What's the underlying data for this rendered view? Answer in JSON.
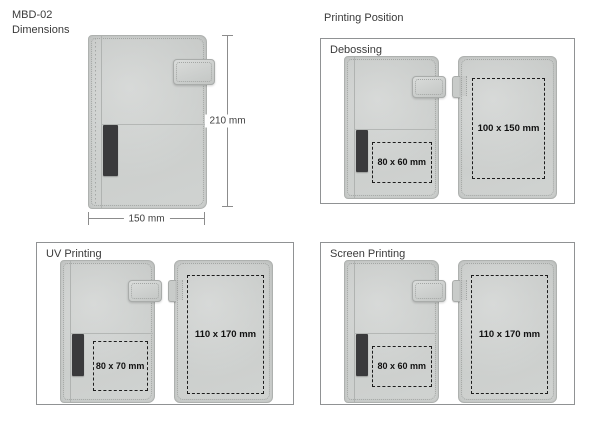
{
  "header": {
    "product_code": "MBD-02",
    "subtitle": "Dimensions"
  },
  "dimensions_figure": {
    "height_label": "210 mm",
    "width_label": "150 mm"
  },
  "printing_position": {
    "title": "Printing Position",
    "panels": [
      {
        "label": "Debossing",
        "front_area": "80 x 60 mm",
        "back_area": "100 x 150 mm"
      },
      {
        "label": "UV Printing",
        "front_area": "80 x 70 mm",
        "back_area": "110 x 170 mm"
      },
      {
        "label": "Screen Printing",
        "front_area": "80 x 60 mm",
        "back_area": "110 x 170 mm"
      }
    ]
  },
  "colors": {
    "notebook_gray": "#cdd0ce",
    "pen_loop_black": "#3a3a3c",
    "panel_border": "#909294",
    "dash_black": "#1c1c1c"
  }
}
